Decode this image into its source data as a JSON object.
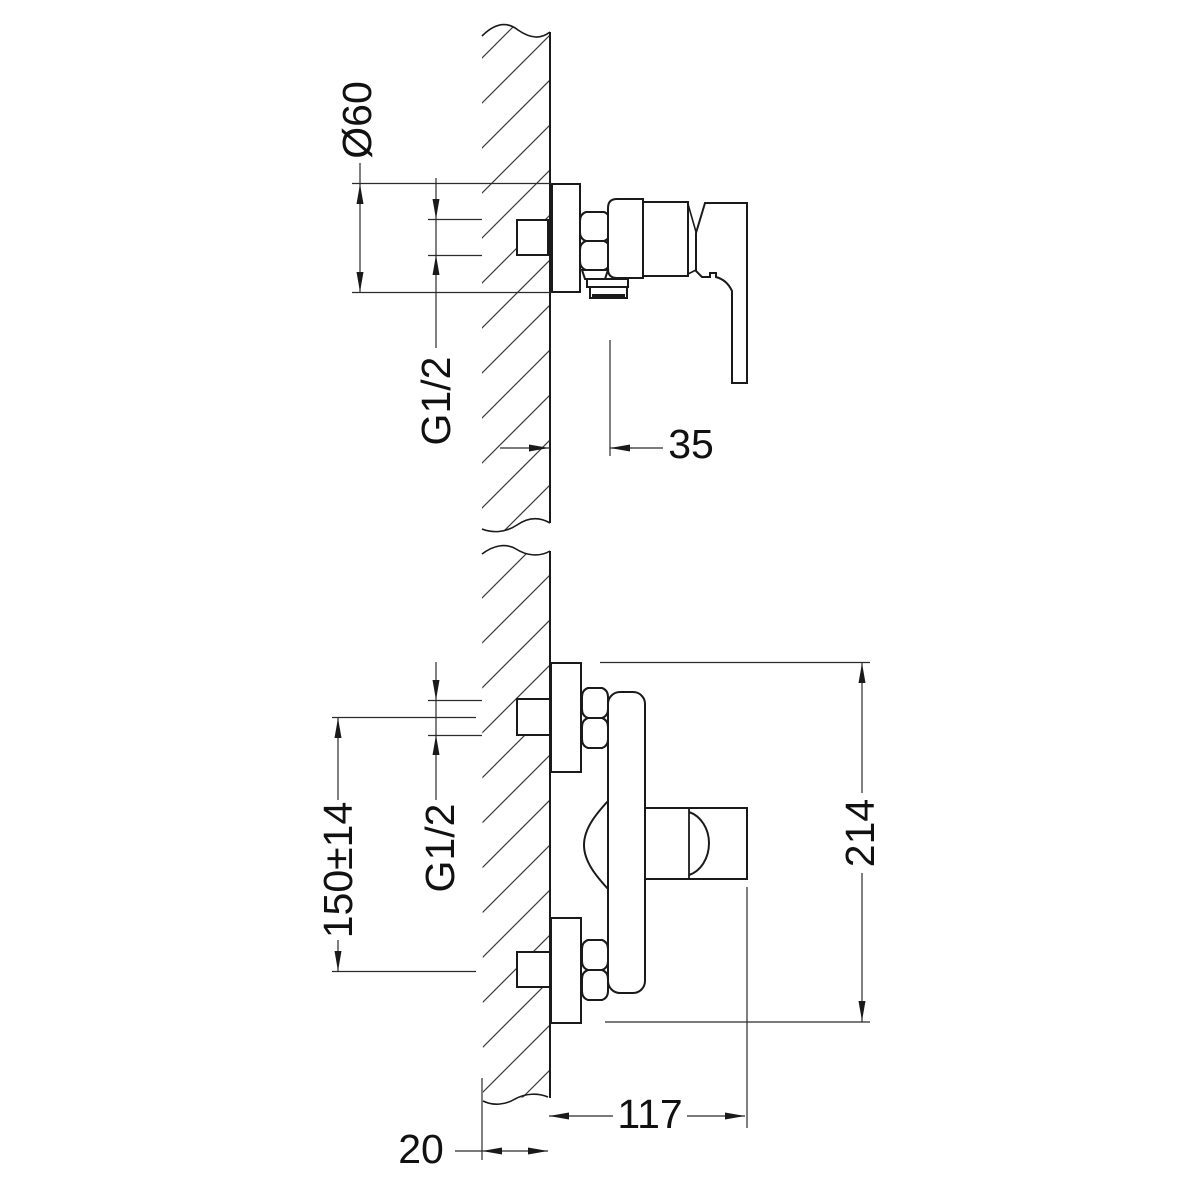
{
  "colors": {
    "background": "#ffffff",
    "object_line": "#1a1a1a",
    "dim_line": "#2b2b2b",
    "hatch_line": "#3a3a3a",
    "text": "#111111"
  },
  "views": {
    "side": {
      "dims": {
        "escutcheon_diameter": "Ø60",
        "connection_thread": "G1/2",
        "outlet_offset": "35"
      }
    },
    "front": {
      "dims": {
        "inlet_spacing": "150±14",
        "connection_thread": "G1/2",
        "overall_height": "214",
        "projection": "117",
        "wall_depth": "20"
      }
    }
  }
}
